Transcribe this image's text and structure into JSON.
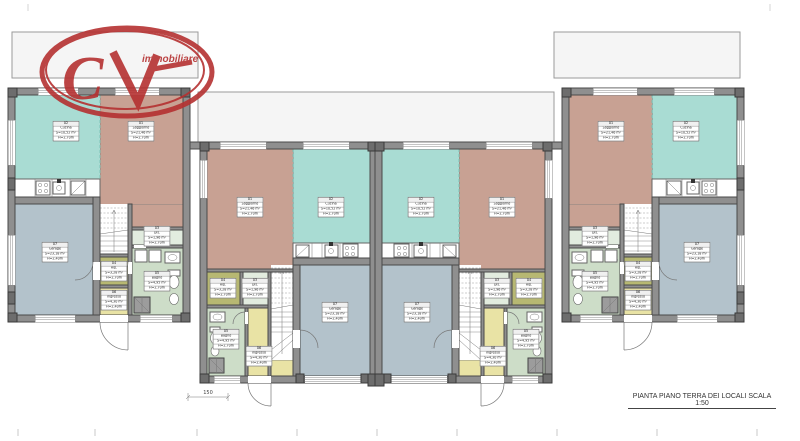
{
  "title": "PIANTA PIANO TERRA DEI LOCALI SCALA 1:50",
  "logo": {
    "letter_c": "C",
    "letter_v": "V",
    "name": "immobiliare"
  },
  "dimension": {
    "value": "150"
  },
  "rooms": {
    "soggiorno": {
      "num": "01",
      "name": "Soggiorno",
      "area": "S=21,46 m²",
      "height": "H=2,70m"
    },
    "cucina": {
      "num": "02",
      "name": "Cucina",
      "area": "S=10,52 m²",
      "height": "H=2,70m"
    },
    "dis": {
      "num": "03",
      "name": "Dis.",
      "area": "S=1,96 m²",
      "height": "H=2,70m"
    },
    "rip": {
      "num": "04",
      "name": "Rip.",
      "area": "S=3,28 m²",
      "height": "H=2,70m"
    },
    "bagno": {
      "num": "05",
      "name": "Bagno",
      "area": "S=4,95 m²",
      "height": "H=2,70m"
    },
    "ingresso": {
      "num": "06",
      "name": "Ingresso",
      "area": "S=4,30 m²",
      "height": "H=2,40m"
    },
    "garage": {
      "num": "07",
      "name": "Garage",
      "area": "S=23,18 m²",
      "height": "H=2,40m"
    }
  },
  "colors": {
    "kitchen": "#a9dcd3",
    "living": "#c8a193",
    "garage": "#b3c2cb",
    "storage": "#b7b872",
    "hall_pale": "#e2ecdf",
    "bathroom": "#cdddc8",
    "entrance": "#e9e3a5",
    "wall": "#8f8f8f",
    "logo_red": "#b53131",
    "terrace": "#f5f5f5"
  }
}
